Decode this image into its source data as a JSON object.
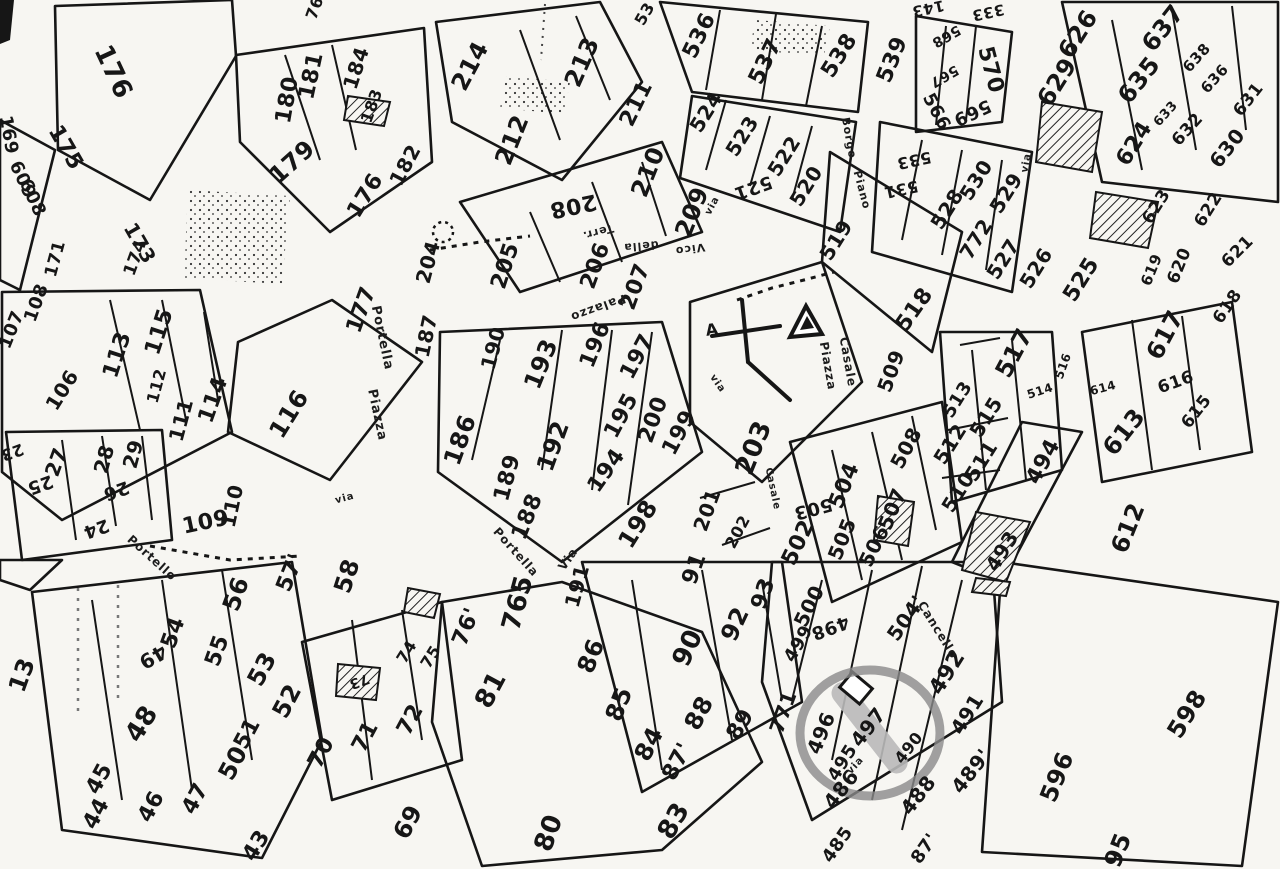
{
  "map": {
    "kind": "scanned cadastral parcel map (catasto), black ink on white paper",
    "colors": {
      "paper": "#f7f6f2",
      "ink": "#161616",
      "highlight_circle": "#8a8a8a",
      "highlighted_parcel_fill": "#b9b9b9"
    },
    "highlight": {
      "description": "hand-drawn grey circle around parcel 497, parcel shaded grey",
      "parcel": "497",
      "cx": 870,
      "cy": 733,
      "rx": 70,
      "ry": 63
    },
    "label_columns": [
      "text",
      "x_px",
      "y_px",
      "rotate_deg",
      "font_px"
    ],
    "parcel_labels": [
      [
        "176",
        113,
        72,
        65,
        26
      ],
      [
        "175",
        65,
        148,
        60,
        22
      ],
      [
        "169",
        8,
        135,
        80,
        18
      ],
      [
        "609",
        22,
        180,
        65,
        18
      ],
      [
        "608",
        32,
        198,
        65,
        18
      ],
      [
        "180",
        288,
        100,
        -80,
        22
      ],
      [
        "181",
        312,
        76,
        -78,
        22
      ],
      [
        "184",
        356,
        68,
        -72,
        20
      ],
      [
        "183",
        372,
        106,
        -70,
        16
      ],
      [
        "179",
        292,
        162,
        -42,
        24
      ],
      [
        "176",
        366,
        196,
        -58,
        22
      ],
      [
        "182",
        405,
        165,
        -62,
        20
      ],
      [
        "173",
        140,
        243,
        60,
        20
      ],
      [
        "174",
        136,
        258,
        -70,
        17
      ],
      [
        "171",
        56,
        259,
        -75,
        17
      ],
      [
        "177",
        362,
        310,
        -70,
        22
      ],
      [
        "187",
        426,
        336,
        -78,
        20
      ],
      [
        "204",
        428,
        262,
        -75,
        20
      ],
      [
        "76",
        315,
        8,
        -70,
        16
      ],
      [
        "53",
        645,
        14,
        -60,
        16
      ],
      [
        "214",
        470,
        66,
        -62,
        24
      ],
      [
        "213",
        582,
        62,
        -66,
        24
      ],
      [
        "212",
        512,
        140,
        -68,
        24
      ],
      [
        "211",
        637,
        104,
        -64,
        22
      ],
      [
        "210",
        648,
        172,
        -68,
        24
      ],
      [
        "208",
        573,
        205,
        168,
        22
      ],
      [
        "209",
        692,
        212,
        -68,
        24
      ],
      [
        "205",
        506,
        266,
        -72,
        22
      ],
      [
        "206",
        596,
        266,
        -70,
        22
      ],
      [
        "207",
        636,
        287,
        -70,
        22
      ],
      [
        "536",
        700,
        36,
        -64,
        22
      ],
      [
        "537",
        766,
        62,
        -64,
        22
      ],
      [
        "538",
        840,
        56,
        -58,
        22
      ],
      [
        "539",
        893,
        60,
        -68,
        22
      ],
      [
        "524",
        706,
        112,
        -58,
        20
      ],
      [
        "523",
        742,
        136,
        -58,
        20
      ],
      [
        "522",
        784,
        156,
        -58,
        20
      ],
      [
        "521",
        753,
        187,
        160,
        18
      ],
      [
        "520",
        806,
        186,
        -58,
        20
      ],
      [
        "519",
        836,
        240,
        -58,
        20
      ],
      [
        "518",
        915,
        310,
        -55,
        22
      ],
      [
        "143",
        928,
        8,
        168,
        15
      ],
      [
        "333",
        988,
        12,
        168,
        15
      ],
      [
        "570",
        990,
        70,
        75,
        22
      ],
      [
        "566",
        936,
        112,
        62,
        18
      ],
      [
        "569",
        972,
        112,
        155,
        18
      ],
      [
        "568",
        946,
        36,
        150,
        14
      ],
      [
        "567",
        944,
        76,
        150,
        14
      ],
      [
        "533",
        914,
        160,
        168,
        16
      ],
      [
        "531",
        901,
        189,
        168,
        16
      ],
      [
        "528",
        947,
        209,
        -58,
        20
      ],
      [
        "530",
        976,
        180,
        -58,
        20
      ],
      [
        "529",
        1006,
        193,
        -58,
        20
      ],
      [
        "772",
        976,
        239,
        -58,
        20
      ],
      [
        "527",
        1003,
        259,
        -58,
        20
      ],
      [
        "526",
        1036,
        268,
        -58,
        20
      ],
      [
        "525",
        1082,
        280,
        -58,
        22
      ],
      [
        "626",
        1078,
        34,
        -58,
        24
      ],
      [
        "629",
        1057,
        82,
        -58,
        24
      ],
      [
        "637",
        1163,
        28,
        -52,
        24
      ],
      [
        "635",
        1139,
        80,
        -52,
        24
      ],
      [
        "638",
        1197,
        58,
        -48,
        15
      ],
      [
        "636",
        1215,
        79,
        -48,
        15
      ],
      [
        "633",
        1166,
        114,
        -48,
        13
      ],
      [
        "632",
        1188,
        130,
        -48,
        17
      ],
      [
        "631",
        1249,
        100,
        -52,
        17
      ],
      [
        "630",
        1227,
        148,
        -52,
        20
      ],
      [
        "624",
        1135,
        144,
        -58,
        22
      ],
      [
        "623",
        1157,
        207,
        -58,
        17
      ],
      [
        "622",
        1209,
        210,
        -58,
        17
      ],
      [
        "621",
        1238,
        252,
        -45,
        17
      ],
      [
        "620",
        1180,
        266,
        -68,
        17
      ],
      [
        "619",
        1152,
        270,
        -68,
        15
      ],
      [
        "618",
        1228,
        307,
        -55,
        17
      ],
      [
        "617",
        1165,
        335,
        -62,
        24
      ],
      [
        "616",
        1176,
        383,
        -20,
        17
      ],
      [
        "615",
        1197,
        412,
        -52,
        17
      ],
      [
        "614",
        1103,
        388,
        -15,
        12
      ],
      [
        "613",
        1124,
        432,
        -52,
        24
      ],
      [
        "612",
        1128,
        528,
        -68,
        24
      ],
      [
        "107",
        12,
        330,
        -68,
        18
      ],
      [
        "108",
        37,
        303,
        -70,
        18
      ],
      [
        "106",
        62,
        390,
        -58,
        20
      ],
      [
        "115",
        160,
        332,
        -72,
        22
      ],
      [
        "113",
        118,
        355,
        -72,
        22
      ],
      [
        "112",
        157,
        386,
        -75,
        16
      ],
      [
        "111",
        181,
        420,
        -75,
        20
      ],
      [
        "114",
        214,
        400,
        -70,
        22
      ],
      [
        "116",
        289,
        414,
        -58,
        24
      ],
      [
        "27",
        56,
        462,
        -70,
        20
      ],
      [
        "28",
        104,
        459,
        -75,
        20
      ],
      [
        "29",
        133,
        454,
        -75,
        20
      ],
      [
        "25",
        40,
        484,
        160,
        18
      ],
      [
        "23",
        12,
        452,
        160,
        16
      ],
      [
        "26",
        116,
        490,
        160,
        18
      ],
      [
        "24",
        96,
        528,
        160,
        18
      ],
      [
        "109",
        206,
        523,
        -12,
        22
      ],
      [
        "110",
        232,
        506,
        -78,
        20
      ],
      [
        "190",
        493,
        348,
        -75,
        20
      ],
      [
        "193",
        541,
        364,
        -68,
        24
      ],
      [
        "196",
        596,
        345,
        -68,
        22
      ],
      [
        "197",
        638,
        357,
        -62,
        22
      ],
      [
        "195",
        622,
        416,
        -62,
        22
      ],
      [
        "200",
        654,
        420,
        -70,
        22
      ],
      [
        "199",
        680,
        433,
        -62,
        22
      ],
      [
        "194",
        607,
        471,
        -55,
        22
      ],
      [
        "192",
        553,
        446,
        -70,
        24
      ],
      [
        "186",
        460,
        440,
        -70,
        24
      ],
      [
        "189",
        508,
        478,
        -75,
        22
      ],
      [
        "188",
        528,
        517,
        -68,
        22
      ],
      [
        "198",
        638,
        524,
        -58,
        24
      ],
      [
        "191",
        577,
        586,
        -75,
        20
      ],
      [
        "201",
        707,
        510,
        -70,
        20
      ],
      [
        "202",
        738,
        532,
        -62,
        16
      ],
      [
        "203",
        754,
        448,
        -68,
        26
      ],
      [
        "A",
        712,
        330,
        -8,
        16
      ],
      [
        "509",
        891,
        371,
        -70,
        20
      ],
      [
        "508",
        906,
        448,
        -62,
        20
      ],
      [
        "507",
        892,
        509,
        -68,
        20
      ],
      [
        "506",
        874,
        546,
        -64,
        20
      ],
      [
        "505",
        842,
        539,
        -68,
        20
      ],
      [
        "504",
        845,
        486,
        -68,
        22
      ],
      [
        "503",
        813,
        508,
        165,
        18
      ],
      [
        "502",
        799,
        543,
        -64,
        22
      ],
      [
        "500",
        809,
        606,
        -64,
        20
      ],
      [
        "499",
        799,
        644,
        -60,
        18
      ],
      [
        "498",
        830,
        627,
        160,
        18
      ],
      [
        "513",
        958,
        400,
        -58,
        18
      ],
      [
        "515",
        986,
        417,
        -58,
        20
      ],
      [
        "512",
        950,
        444,
        -58,
        20
      ],
      [
        "511",
        981,
        461,
        -58,
        20
      ],
      [
        "510",
        958,
        492,
        -58,
        20
      ],
      [
        "514",
        1040,
        391,
        -18,
        12
      ],
      [
        "516",
        1063,
        366,
        -70,
        12
      ],
      [
        "517",
        1014,
        353,
        -62,
        24
      ],
      [
        "494",
        1044,
        462,
        -62,
        22
      ],
      [
        "493",
        1002,
        551,
        -58,
        20
      ],
      [
        "771",
        783,
        712,
        -70,
        20
      ],
      [
        "496",
        821,
        733,
        -68,
        20
      ],
      [
        "497",
        868,
        727,
        -52,
        20
      ],
      [
        "495",
        843,
        763,
        -58,
        18
      ],
      [
        "486",
        841,
        789,
        -52,
        20
      ],
      [
        "488",
        918,
        795,
        -52,
        20
      ],
      [
        "490",
        909,
        748,
        -52,
        16
      ],
      [
        "489'",
        971,
        771,
        -52,
        20
      ],
      [
        "491",
        967,
        714,
        -58,
        20
      ],
      [
        "492",
        948,
        673,
        -58,
        22
      ],
      [
        "504'",
        906,
        618,
        -55,
        20
      ],
      [
        "485",
        838,
        845,
        -55,
        18
      ],
      [
        "87'",
        925,
        849,
        -55,
        18
      ],
      [
        "598",
        1187,
        714,
        -58,
        24
      ],
      [
        "596",
        1057,
        777,
        -68,
        24
      ],
      [
        "95",
        1118,
        850,
        -68,
        24
      ],
      [
        "13",
        22,
        675,
        -70,
        24
      ],
      [
        "48",
        142,
        724,
        -58,
        26
      ],
      [
        "49",
        153,
        657,
        150,
        20
      ],
      [
        "54",
        174,
        633,
        -70,
        22
      ],
      [
        "55",
        218,
        651,
        -70,
        22
      ],
      [
        "56",
        236,
        594,
        -70,
        24
      ],
      [
        "57'",
        291,
        573,
        -68,
        22
      ],
      [
        "58",
        347,
        576,
        -72,
        24
      ],
      [
        "53",
        262,
        669,
        -62,
        24
      ],
      [
        "52",
        287,
        701,
        -62,
        24
      ],
      [
        "51",
        248,
        734,
        -62,
        22
      ],
      [
        "50",
        233,
        763,
        -62,
        24
      ],
      [
        "45",
        100,
        779,
        -62,
        22
      ],
      [
        "44",
        97,
        814,
        -62,
        22
      ],
      [
        "46",
        152,
        807,
        -62,
        22
      ],
      [
        "47",
        196,
        799,
        -62,
        22
      ],
      [
        "43",
        257,
        846,
        -58,
        22
      ],
      [
        "70",
        322,
        753,
        -62,
        22
      ],
      [
        "71",
        366,
        737,
        -62,
        22
      ],
      [
        "72",
        411,
        720,
        -62,
        22
      ],
      [
        "69",
        408,
        822,
        -62,
        24
      ],
      [
        "73",
        359,
        681,
        160,
        14
      ],
      [
        "74",
        407,
        652,
        -58,
        16
      ],
      [
        "75",
        431,
        657,
        -58,
        16
      ],
      [
        "765",
        518,
        603,
        -75,
        26
      ],
      [
        "76'",
        467,
        627,
        -68,
        22
      ],
      [
        "81",
        491,
        690,
        -62,
        26
      ],
      [
        "86",
        591,
        656,
        -68,
        24
      ],
      [
        "85",
        619,
        704,
        -68,
        24
      ],
      [
        "84",
        649,
        744,
        -62,
        24
      ],
      [
        "87'",
        678,
        762,
        -62,
        22
      ],
      [
        "88",
        699,
        713,
        -62,
        24
      ],
      [
        "89",
        741,
        725,
        -58,
        22
      ],
      [
        "90",
        688,
        648,
        -65,
        26
      ],
      [
        "91",
        695,
        569,
        -70,
        22
      ],
      [
        "92",
        735,
        624,
        -65,
        24
      ],
      [
        "93",
        764,
        594,
        -70,
        22
      ],
      [
        "83",
        674,
        821,
        -60,
        26
      ],
      [
        "80",
        549,
        833,
        -70,
        26
      ]
    ],
    "street_labels": [
      [
        "Vico",
        690,
        249,
        172,
        11
      ],
      [
        "della",
        641,
        246,
        175,
        11
      ],
      [
        "Terr.",
        598,
        232,
        165,
        11
      ],
      [
        "Palazzo",
        598,
        308,
        160,
        12
      ],
      [
        "Piazza",
        377,
        415,
        78,
        13
      ],
      [
        "Portella",
        382,
        338,
        78,
        13
      ],
      [
        "Via",
        568,
        559,
        -55,
        12
      ],
      [
        "Portella",
        516,
        552,
        48,
        12
      ],
      [
        "Portello",
        152,
        558,
        42,
        12
      ],
      [
        "via",
        345,
        499,
        -15,
        10
      ],
      [
        "via",
        713,
        206,
        -62,
        10
      ],
      [
        "via",
        717,
        384,
        55,
        10
      ],
      [
        "via",
        856,
        766,
        -48,
        10
      ],
      [
        "via",
        1027,
        163,
        -80,
        10
      ],
      [
        "Piazza",
        828,
        366,
        80,
        12
      ],
      [
        "Casale",
        848,
        362,
        80,
        12
      ],
      [
        "Casale",
        772,
        489,
        78,
        10
      ],
      [
        "Cancello",
        938,
        630,
        58,
        12
      ],
      [
        "Borgo",
        849,
        138,
        80,
        11
      ],
      [
        "Piano",
        862,
        190,
        75,
        11
      ]
    ],
    "symbols": [
      "church-cross-icon",
      "landmark-triangle-icon",
      "highlight-circle",
      "survey-dotted-circle",
      "dashed-path",
      "hatched-parcels",
      "stippled-parcels"
    ]
  }
}
